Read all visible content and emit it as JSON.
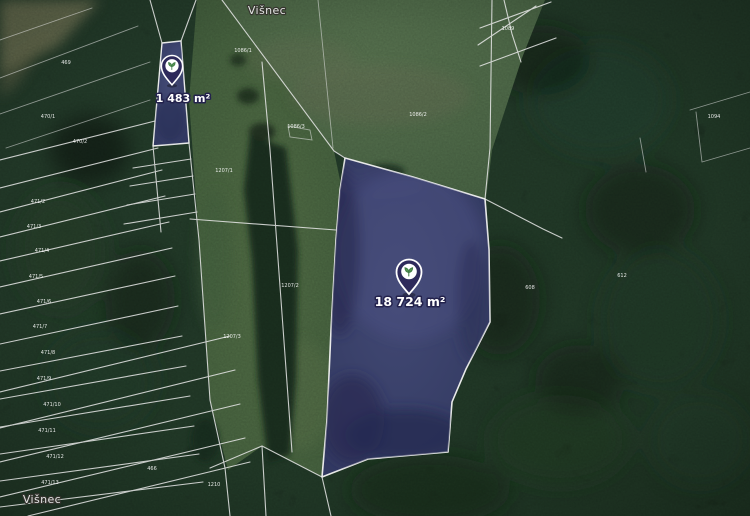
{
  "map": {
    "type": "satellite-imagery-with-cadastre",
    "place_labels": [
      {
        "text": "Višnec"
      },
      {
        "text": "Višnec"
      }
    ],
    "parcels": [
      {
        "name": "parcel-small",
        "area_label": "1 483 m²",
        "marker_icon": "plant-icon",
        "fill": "#3a3f6c",
        "border": "#f2f2f2"
      },
      {
        "name": "parcel-large",
        "area_label": "18 724 m²",
        "marker_icon": "plant-icon",
        "fill": "#3b4370",
        "border": "#f2f2f2"
      }
    ],
    "parcel_numbers": [
      {
        "text": "471/2"
      },
      {
        "text": "471/3"
      },
      {
        "text": "471/4"
      },
      {
        "text": "471/5"
      },
      {
        "text": "471/6"
      },
      {
        "text": "471/7"
      },
      {
        "text": "471/8"
      },
      {
        "text": "471/9"
      },
      {
        "text": "471/10"
      },
      {
        "text": "471/11"
      },
      {
        "text": "471/12"
      },
      {
        "text": "471/13"
      },
      {
        "text": "469"
      },
      {
        "text": "470/1"
      },
      {
        "text": "470/2"
      },
      {
        "text": "1086/1"
      },
      {
        "text": "1086/2"
      },
      {
        "text": "1086/3"
      },
      {
        "text": "1089"
      },
      {
        "text": "1207/1"
      },
      {
        "text": "1207/2"
      },
      {
        "text": "1207/3"
      },
      {
        "text": "608"
      },
      {
        "text": "612"
      },
      {
        "text": "1094"
      },
      {
        "text": "1210"
      },
      {
        "text": "466"
      }
    ],
    "colors": {
      "forest": "#1c2e21",
      "meadow": "#53704e",
      "parcel_fill": "#3b4270",
      "parcel_border": "#f2f2f2",
      "marker_fill": "#2e2a5b",
      "boundary_line": "#e8e8e8",
      "label_text": "#ffffff"
    }
  }
}
